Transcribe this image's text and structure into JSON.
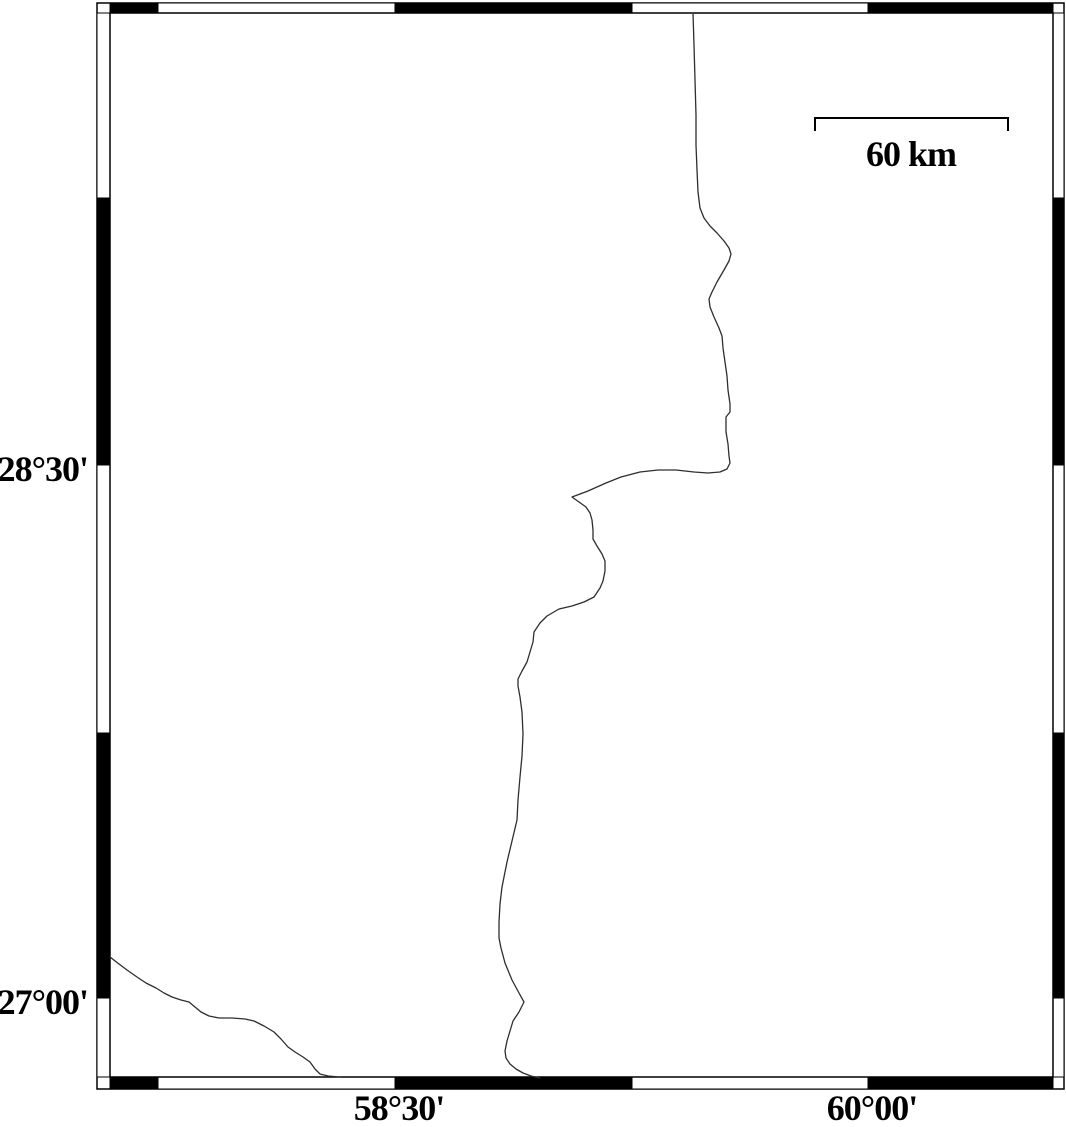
{
  "map": {
    "colors": {
      "background": "#ffffff",
      "frame": "#000000",
      "line": "#2e2e2e"
    },
    "scale_bar": {
      "label": "60 km",
      "x1": 815,
      "x2": 1008,
      "y": 118,
      "tick_drop": 13,
      "label_x": 911,
      "label_y": 166
    },
    "graticule": {
      "latitude": [
        {
          "text": "28°30'",
          "y": 465
        },
        {
          "text": "27°00'",
          "y": 998
        }
      ],
      "longitude": [
        {
          "text": "58°30'",
          "x": 395
        },
        {
          "text": "60°00'",
          "x": 868
        }
      ]
    },
    "frame": {
      "outer": [
        97,
        3,
        1064,
        1089
      ],
      "inner": [
        110,
        13,
        1053,
        1077
      ],
      "x_breaks": [
        110,
        158,
        395,
        632,
        868,
        1053
      ],
      "x_fills": [
        "black",
        "white",
        "black",
        "white",
        "black"
      ],
      "y_breaks": [
        13,
        198,
        465,
        733,
        998,
        1077
      ],
      "y_fills": [
        "white",
        "black",
        "white",
        "black",
        "white"
      ]
    },
    "coastlines": [
      {
        "name": "main-boundary-line",
        "points": [
          [
            693,
            13
          ],
          [
            694,
            45
          ],
          [
            695,
            80
          ],
          [
            696,
            115
          ],
          [
            696,
            145
          ],
          [
            697,
            170
          ],
          [
            698,
            192
          ],
          [
            700,
            208
          ],
          [
            704,
            218
          ],
          [
            710,
            226
          ],
          [
            717,
            233
          ],
          [
            724,
            241
          ],
          [
            729,
            248
          ],
          [
            731,
            254
          ],
          [
            729,
            261
          ],
          [
            724,
            270
          ],
          [
            717,
            282
          ],
          [
            712,
            292
          ],
          [
            709,
            299
          ],
          [
            710,
            307
          ],
          [
            714,
            317
          ],
          [
            719,
            328
          ],
          [
            722,
            336
          ],
          [
            723,
            348
          ],
          [
            725,
            362
          ],
          [
            727,
            376
          ],
          [
            728,
            390
          ],
          [
            730,
            404
          ],
          [
            730,
            412
          ],
          [
            726,
            417
          ],
          [
            726,
            432
          ],
          [
            728,
            444
          ],
          [
            729,
            456
          ],
          [
            730,
            463
          ],
          [
            727,
            469
          ],
          [
            720,
            472
          ],
          [
            708,
            473
          ],
          [
            694,
            472
          ],
          [
            676,
            470
          ],
          [
            658,
            470
          ],
          [
            640,
            472
          ],
          [
            621,
            477
          ],
          [
            606,
            483
          ],
          [
            588,
            491
          ],
          [
            572,
            497
          ],
          [
            579,
            502
          ],
          [
            586,
            507
          ],
          [
            590,
            513
          ],
          [
            592,
            520
          ],
          [
            593,
            530
          ],
          [
            593,
            539
          ],
          [
            597,
            546
          ],
          [
            602,
            554
          ],
          [
            605,
            561
          ],
          [
            605,
            571
          ],
          [
            603,
            581
          ],
          [
            600,
            588
          ],
          [
            594,
            597
          ],
          [
            584,
            602
          ],
          [
            572,
            606
          ],
          [
            559,
            609
          ],
          [
            547,
            616
          ],
          [
            540,
            623
          ],
          [
            534,
            632
          ],
          [
            533,
            642
          ],
          [
            530,
            652
          ],
          [
            527,
            662
          ],
          [
            522,
            671
          ],
          [
            518,
            679
          ],
          [
            518,
            686
          ],
          [
            520,
            697
          ],
          [
            522,
            712
          ],
          [
            523,
            734
          ],
          [
            522,
            756
          ],
          [
            520,
            777
          ],
          [
            518,
            800
          ],
          [
            517,
            820
          ],
          [
            512,
            841
          ],
          [
            507,
            862
          ],
          [
            502,
            887
          ],
          [
            500,
            904
          ],
          [
            499,
            922
          ],
          [
            499,
            938
          ],
          [
            501,
            948
          ],
          [
            505,
            963
          ],
          [
            512,
            980
          ],
          [
            519,
            993
          ],
          [
            524,
            1002
          ],
          [
            519,
            1012
          ],
          [
            513,
            1021
          ],
          [
            510,
            1031
          ],
          [
            507,
            1041
          ],
          [
            505,
            1051
          ],
          [
            506,
            1058
          ],
          [
            510,
            1064
          ],
          [
            516,
            1069
          ],
          [
            523,
            1073
          ],
          [
            531,
            1076
          ],
          [
            540,
            1078
          ]
        ]
      },
      {
        "name": "southwest-coast-line",
        "points": [
          [
            110,
            957
          ],
          [
            119,
            964
          ],
          [
            127,
            970
          ],
          [
            137,
            977
          ],
          [
            146,
            983
          ],
          [
            156,
            988
          ],
          [
            164,
            993
          ],
          [
            172,
            997
          ],
          [
            181,
            1000
          ],
          [
            189,
            1002
          ],
          [
            195,
            1007
          ],
          [
            201,
            1012
          ],
          [
            209,
            1016
          ],
          [
            219,
            1018
          ],
          [
            232,
            1018
          ],
          [
            245,
            1019
          ],
          [
            254,
            1021
          ],
          [
            264,
            1026
          ],
          [
            274,
            1032
          ],
          [
            281,
            1039
          ],
          [
            288,
            1047
          ],
          [
            295,
            1052
          ],
          [
            303,
            1057
          ],
          [
            310,
            1062
          ],
          [
            315,
            1069
          ],
          [
            320,
            1074
          ],
          [
            328,
            1076
          ],
          [
            340,
            1077
          ]
        ]
      }
    ]
  }
}
